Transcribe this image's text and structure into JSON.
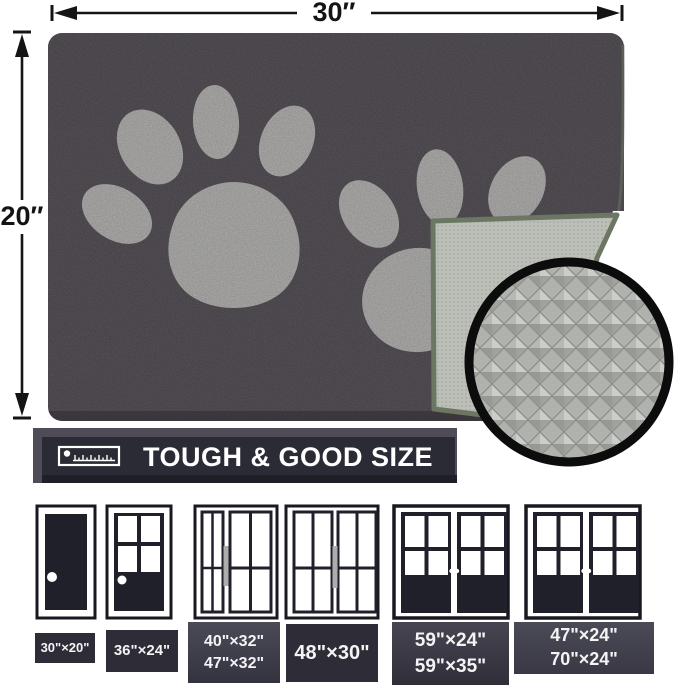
{
  "dimensions": {
    "width_label": "30″",
    "height_label": "20″"
  },
  "banner": {
    "icon": "ruler-icon",
    "title": "TOUGH & GOOD SIZE"
  },
  "mat": {
    "description": "dark gray paw print door mat with folded corner showing anti-slip backing",
    "inset": "anti-slip-backing-texture"
  },
  "doors": [
    {
      "type": "single solid door",
      "sizes": [
        "30\"×20\""
      ]
    },
    {
      "type": "single half-glass door",
      "sizes": [
        "36\"×24\""
      ]
    },
    {
      "type": "door with sidelight",
      "sizes": [
        "40\"×32\"",
        "47\"×32\""
      ]
    },
    {
      "type": "double glass door",
      "sizes": [
        "48\"×30\""
      ]
    },
    {
      "type": "french double door",
      "sizes": [
        "59\"×24\"",
        "59\"×35\""
      ]
    },
    {
      "type": "wide french double door",
      "sizes": [
        "47\"×24\"",
        "70\"×24\""
      ]
    }
  ],
  "colors": {
    "mat": "#48424a",
    "paw": "#b9b8b6",
    "backing": "#bcbeb8",
    "edge_binding": "#6b7663",
    "banner_front": "#2b2b35",
    "banner_back": "#4f4b57",
    "door_slab": "#20202b",
    "label_bg": "#2e2d37",
    "text": "#ffffff"
  }
}
